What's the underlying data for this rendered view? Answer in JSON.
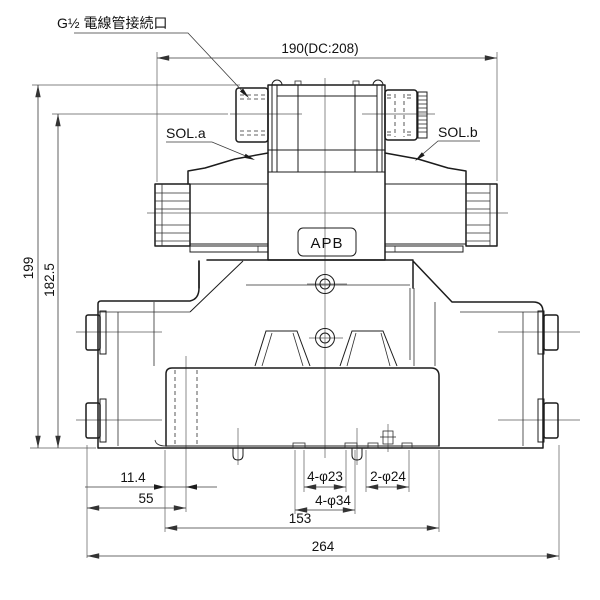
{
  "drawing": {
    "callouts": {
      "conduit": "G½ 電線管接続口",
      "sol_a": "SOL.a",
      "sol_b": "SOL.b",
      "model_badge": "APB"
    },
    "dims": {
      "top_width": "190(DC:208)",
      "overall_height": "199",
      "conduit_height": "182.5",
      "hole_offset_small": "11.4",
      "hole_offset": "55",
      "mount_holes": "4-φ23",
      "side_holes": "2-φ24",
      "counterbores": "4-φ34",
      "plate_width": "153",
      "overall_width": "264"
    }
  }
}
